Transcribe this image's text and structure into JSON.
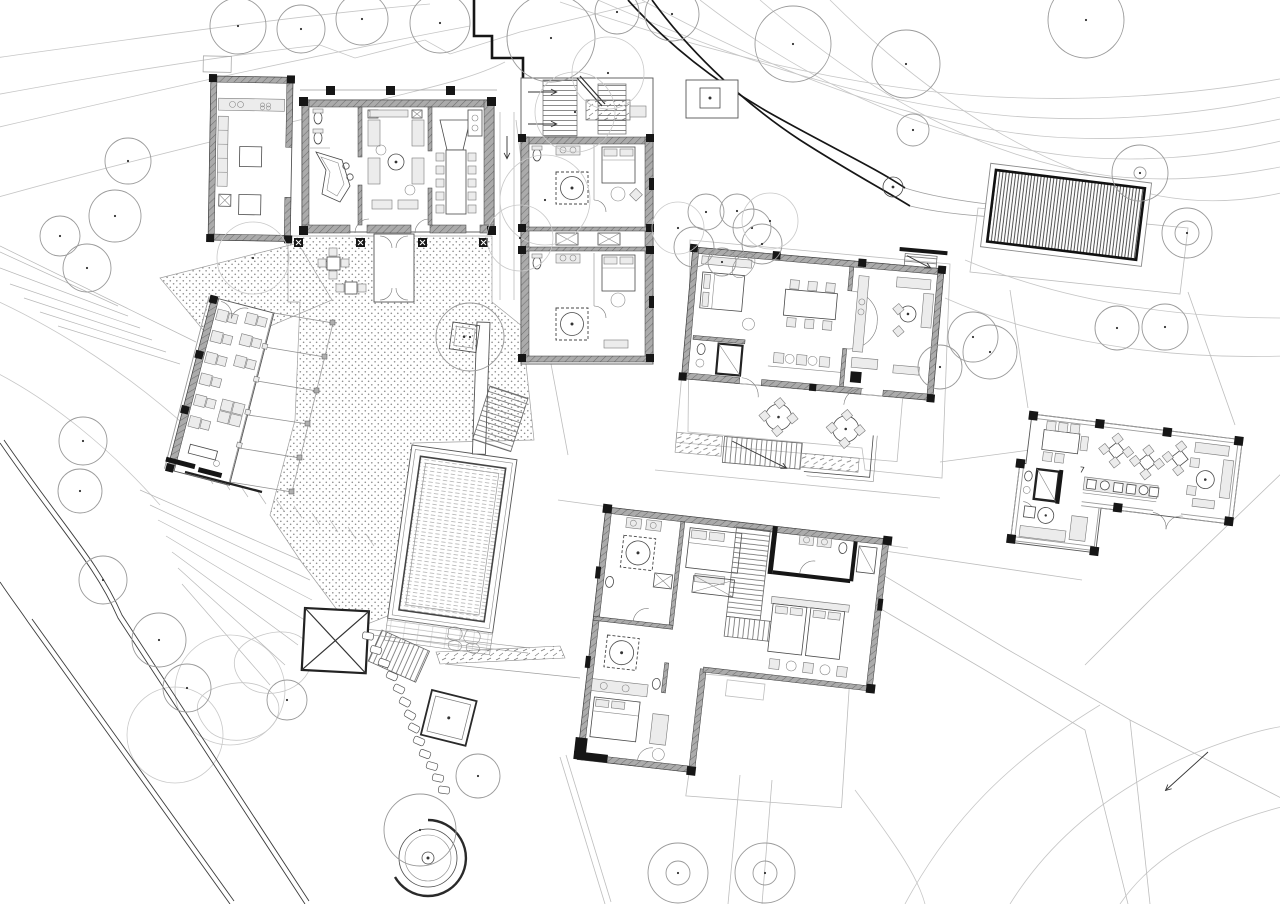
{
  "document": {
    "type": "architectural site plan",
    "style": "black and white CAD line drawing, ground-floor furniture plan of a hillside resort",
    "paper": "#ffffff"
  },
  "palette": {
    "ink": "#161616",
    "wall_gray": "#9a9a9a",
    "medium_line": "#555555",
    "light_line": "#bdbdbd",
    "contour_line": "#c6c6c6",
    "tree_line": "#9a9a9a",
    "stipple_dot": "#8e8e8e"
  },
  "annotations": {
    "door_number": "7"
  },
  "buildings": [
    {
      "id": "main-lodge",
      "label": "main lodge: restrooms, piano bar, central lounge, V dining table, kitchen wing, planter terrace"
    },
    {
      "id": "guest-suites",
      "label": "guest suite block: two suites with round tubs, beds, twin entry stairs with arrows"
    },
    {
      "id": "garden-villa",
      "label": "garden villa: bedroom, bathroom, dining table, bar stools, kitchen, living room, round-table terrace"
    },
    {
      "id": "bedroom-wing",
      "label": "bedroom wing: four suites, two round tubs, central staircase, twin-bed room, lawn court"
    },
    {
      "id": "pavilion",
      "label": "L-shaped pavilion: meeting table, cafe diamond tables, bar counter, lounge, bathroom suite"
    },
    {
      "id": "restaurant-terrace",
      "label": "open-air restaurant: table rows along stone wall, pergola beams, entry gate"
    }
  ],
  "site": {
    "pool": {
      "shape": "rectangle",
      "texture": "horizontal water hatch",
      "deck": "plank deck with rock patch"
    },
    "spa": {
      "shape": "concentric circles with broken outer ring"
    },
    "parking_canopy": {
      "texture": "dense vertical hatch",
      "frame": "heavy black rectangle"
    },
    "roads": {
      "access_road": "double-edged road, lower left",
      "driveway": "bold curved road, top centre-right",
      "footpath": "faint branched path with arrow, lower right"
    },
    "terraces": [
      "stippled central courtyard",
      "upper planter terrace",
      "north gravel patch"
    ],
    "deck_square": "X-braced timber deck",
    "pad_square": "small double-border pad with centre dot",
    "trees": [
      {
        "x": 238,
        "y": 26,
        "r": 28
      },
      {
        "x": 301,
        "y": 29,
        "r": 24
      },
      {
        "x": 362,
        "y": 19,
        "r": 26
      },
      {
        "x": 440,
        "y": 23,
        "r": 30
      },
      {
        "x": 551,
        "y": 38,
        "r": 44
      },
      {
        "x": 617,
        "y": 12,
        "r": 22
      },
      {
        "x": 672,
        "y": 14,
        "r": 27
      },
      {
        "x": 793,
        "y": 44,
        "r": 38
      },
      {
        "x": 906,
        "y": 64,
        "r": 34
      },
      {
        "x": 1086,
        "y": 20,
        "r": 38
      },
      {
        "x": 913,
        "y": 130,
        "r": 16
      },
      {
        "x": 1140,
        "y": 173,
        "r": 28,
        "ir": 6
      },
      {
        "x": 1187,
        "y": 233,
        "r": 25,
        "ir": 12
      },
      {
        "x": 1117,
        "y": 328,
        "r": 22
      },
      {
        "x": 1165,
        "y": 327,
        "r": 23
      },
      {
        "x": 973,
        "y": 337,
        "r": 25
      },
      {
        "x": 990,
        "y": 352,
        "r": 27
      },
      {
        "x": 940,
        "y": 367,
        "r": 22
      },
      {
        "x": 706,
        "y": 212,
        "r": 18
      },
      {
        "x": 737,
        "y": 211,
        "r": 17
      },
      {
        "x": 752,
        "y": 228,
        "r": 19
      },
      {
        "x": 762,
        "y": 244,
        "r": 20
      },
      {
        "x": 694,
        "y": 247,
        "r": 20
      },
      {
        "x": 722,
        "y": 262,
        "r": 14
      },
      {
        "x": 678,
        "y": 228,
        "r": 26,
        "f": 1
      },
      {
        "x": 770,
        "y": 221,
        "r": 28,
        "f": 1
      },
      {
        "x": 128,
        "y": 161,
        "r": 23
      },
      {
        "x": 115,
        "y": 216,
        "r": 26
      },
      {
        "x": 87,
        "y": 268,
        "r": 24
      },
      {
        "x": 60,
        "y": 236,
        "r": 20
      },
      {
        "x": 83,
        "y": 441,
        "r": 24
      },
      {
        "x": 80,
        "y": 491,
        "r": 22
      },
      {
        "x": 103,
        "y": 580,
        "r": 24
      },
      {
        "x": 159,
        "y": 640,
        "r": 27
      },
      {
        "x": 187,
        "y": 688,
        "r": 24
      },
      {
        "x": 287,
        "y": 700,
        "r": 20
      },
      {
        "x": 420,
        "y": 830,
        "r": 36
      },
      {
        "x": 478,
        "y": 776,
        "r": 22
      },
      {
        "x": 678,
        "y": 873,
        "r": 30,
        "ir": 12
      },
      {
        "x": 765,
        "y": 873,
        "r": 30,
        "ir": 12
      },
      {
        "x": 545,
        "y": 200,
        "r": 45,
        "f": 1
      },
      {
        "x": 575,
        "y": 112,
        "r": 40,
        "f": 1
      },
      {
        "x": 520,
        "y": 238,
        "r": 33,
        "f": 1
      },
      {
        "x": 253,
        "y": 258,
        "r": 36,
        "f": 1
      },
      {
        "x": 470,
        "y": 337,
        "r": 34
      },
      {
        "x": 608,
        "y": 73,
        "r": 36,
        "f": 1
      }
    ],
    "stepping_stones": [
      {
        "x": 368,
        "y": 636,
        "a": 10
      },
      {
        "x": 376,
        "y": 650,
        "a": 16
      },
      {
        "x": 384,
        "y": 663,
        "a": 20
      },
      {
        "x": 392,
        "y": 676,
        "a": 24
      },
      {
        "x": 399,
        "y": 689,
        "a": 26
      },
      {
        "x": 405,
        "y": 702,
        "a": 28
      },
      {
        "x": 410,
        "y": 715,
        "a": 30
      },
      {
        "x": 414,
        "y": 728,
        "a": 28
      },
      {
        "x": 419,
        "y": 741,
        "a": 24
      },
      {
        "x": 425,
        "y": 754,
        "a": 20
      },
      {
        "x": 432,
        "y": 766,
        "a": 16
      },
      {
        "x": 438,
        "y": 778,
        "a": 12
      },
      {
        "x": 444,
        "y": 790,
        "a": 8
      }
    ]
  }
}
